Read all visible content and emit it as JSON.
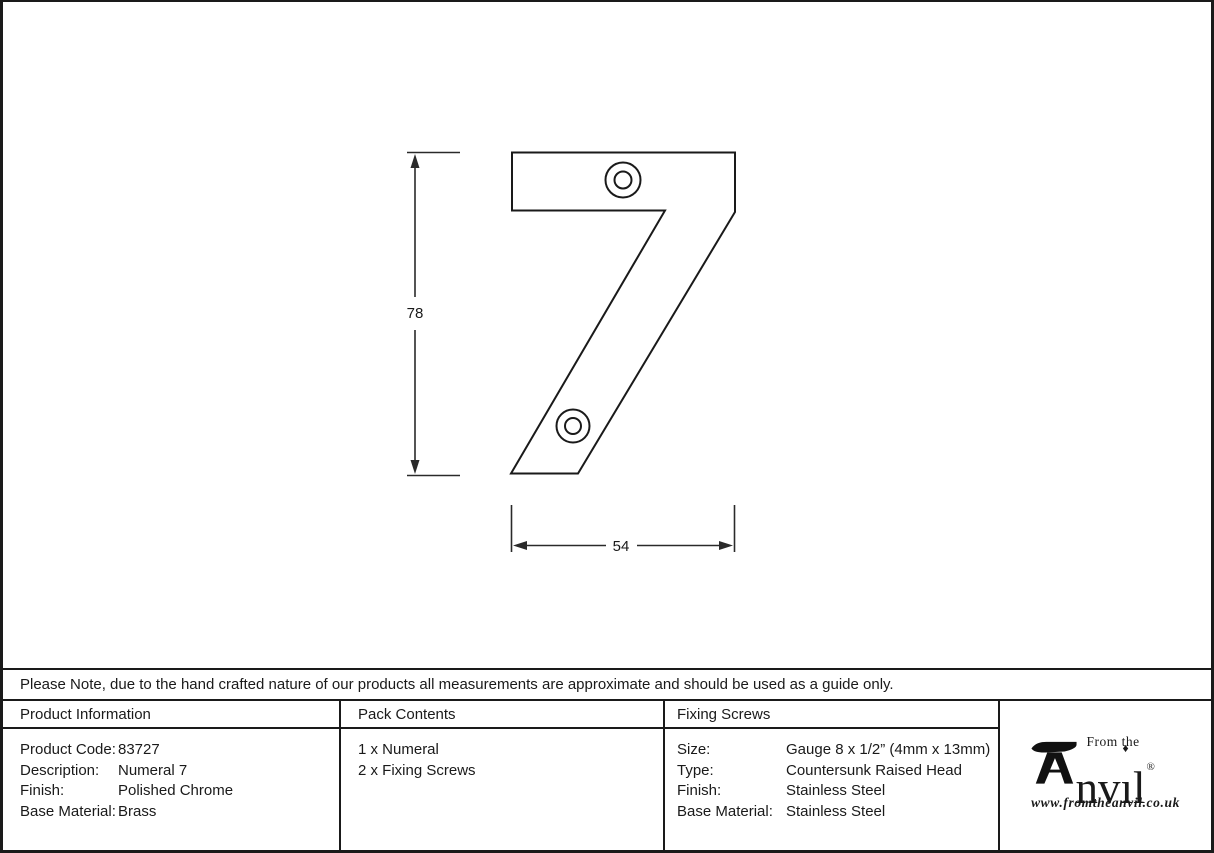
{
  "drawing": {
    "height_dim": "78",
    "width_dim": "54"
  },
  "note": "Please Note, due to the hand crafted nature of our products all measurements are approximate and should be used as a guide only.",
  "table": {
    "product_info": {
      "header": "Product Information",
      "rows": [
        {
          "label": "Product Code:",
          "value": "83727"
        },
        {
          "label": "Description:",
          "value": "Numeral 7"
        },
        {
          "label": "Finish:",
          "value": "Polished Chrome"
        },
        {
          "label": "Base Material:",
          "value": "Brass"
        }
      ]
    },
    "pack_contents": {
      "header": "Pack Contents",
      "items": [
        "1 x Numeral",
        "2 x Fixing Screws"
      ]
    },
    "fixing_screws": {
      "header": "Fixing Screws",
      "rows": [
        {
          "label": "Size:",
          "value": "Gauge 8 x 1/2” (4mm x 13mm)"
        },
        {
          "label": "Type:",
          "value": "Countersunk Raised Head"
        },
        {
          "label": "Finish:",
          "value": "Stainless Steel"
        },
        {
          "label": "Base Material:",
          "value": "Stainless Steel"
        }
      ]
    }
  },
  "logo": {
    "tagline": "From the",
    "brand_prefix": "nv",
    "brand_i": "ı",
    "i_dot": "♦",
    "brand_suffix": "l",
    "registered": "®",
    "url": "www.fromtheanvil.co.uk"
  },
  "colors": {
    "line": "#1a1a1a",
    "background": "#ffffff"
  }
}
